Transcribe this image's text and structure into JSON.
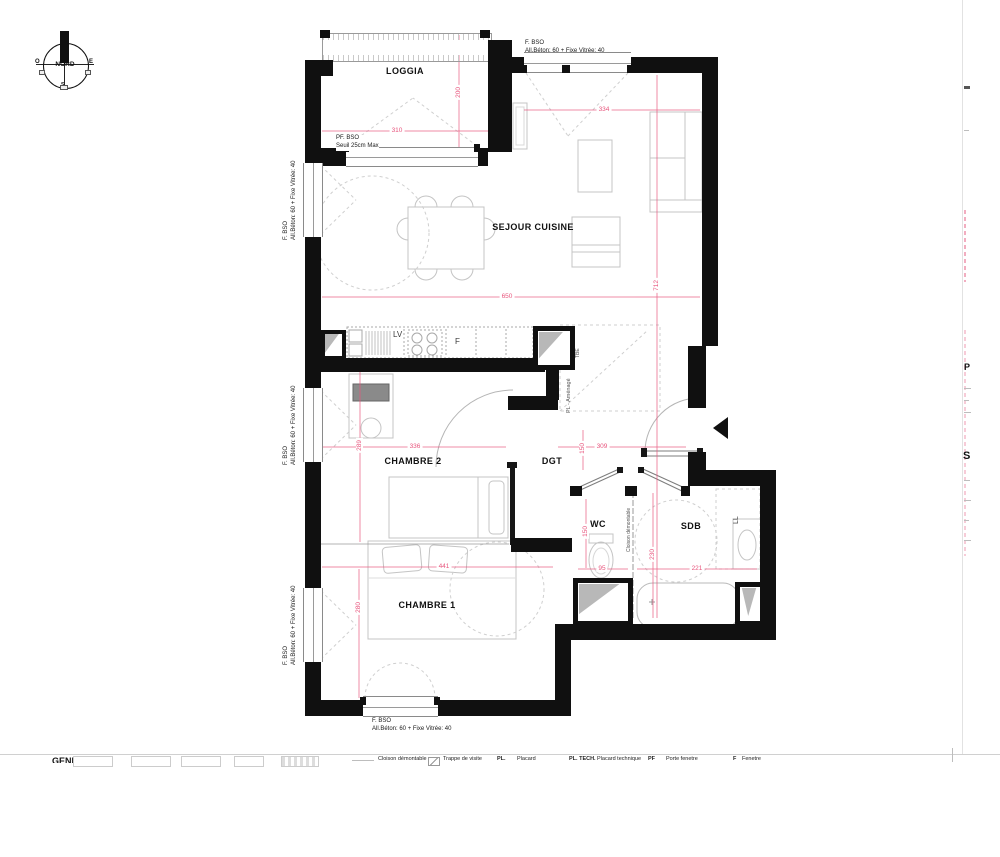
{
  "colors": {
    "wall": "#101010",
    "dimension": "#e8557d",
    "linework": "#bfbfbf",
    "triangle": "#b8b8b8"
  },
  "compass": {
    "label": "NORD",
    "west": "O",
    "east": "E",
    "south": "S"
  },
  "rooms": {
    "loggia": "LOGGIA",
    "sejour_cuisine": "SEJOUR CUISINE",
    "chambre2": "CHAMBRE 2",
    "dgt": "DGT",
    "wc": "WC",
    "sdb": "SDB",
    "chambre1": "CHAMBRE 1"
  },
  "fixtures": {
    "dishwasher": "LV",
    "fridge": "F",
    "tbe": "TBE",
    "closet": "PL - Aménagé",
    "partition": "Cloison démontable",
    "washing_machine": "LL"
  },
  "notes": {
    "top_window": {
      "line1": "F. BSO",
      "line2": "All.Béton: 60 + Fixe Vitrée: 40"
    },
    "loggia_door": {
      "line1": "PF. BSO",
      "line2": "Seuil 25cm Max"
    },
    "left_window_1": {
      "line1": "F. BSO",
      "line2": "All.Béton: 60 + Fixe Vitrée: 40"
    },
    "left_window_2": {
      "line1": "F. BSO",
      "line2": "All.Béton: 60 + Fixe Vitrée: 40"
    },
    "left_window_3": {
      "line1": "F. BSO",
      "line2": "All.Béton: 60 + Fixe Vitrée: 40"
    },
    "bottom_window": {
      "line1": "F. BSO",
      "line2": "All.Béton: 60 + Fixe Vitrée: 40"
    }
  },
  "dimensions": {
    "loggia_width": "310",
    "loggia_depth": "200",
    "sejour_top": "334",
    "sejour_width": "650",
    "apartment_depth": "712",
    "chambre2_width": "336",
    "chambre2_depth": "289",
    "dgt_width": "309",
    "dgt_depth": "150",
    "wc_width": "95",
    "wc_depth": "150",
    "sdb_width": "221",
    "sdb_depth": "230",
    "chambre1_width": "441",
    "chambre1_depth": "280"
  },
  "legend": {
    "genre": "GENRE:",
    "items": [
      {
        "abbr": "",
        "label": "Cloison démontable"
      },
      {
        "abbr": "",
        "label": "Trappe de visite"
      },
      {
        "abbr": "PL.",
        "label": "Placard"
      },
      {
        "abbr": "PL. TECH.",
        "label": "Placard technique"
      },
      {
        "abbr": "PF",
        "label": "Porte fenetre"
      },
      {
        "abbr": "F",
        "label": "Fenetre"
      }
    ]
  },
  "edge_fragments": {
    "top": "P",
    "bottom": "S"
  }
}
